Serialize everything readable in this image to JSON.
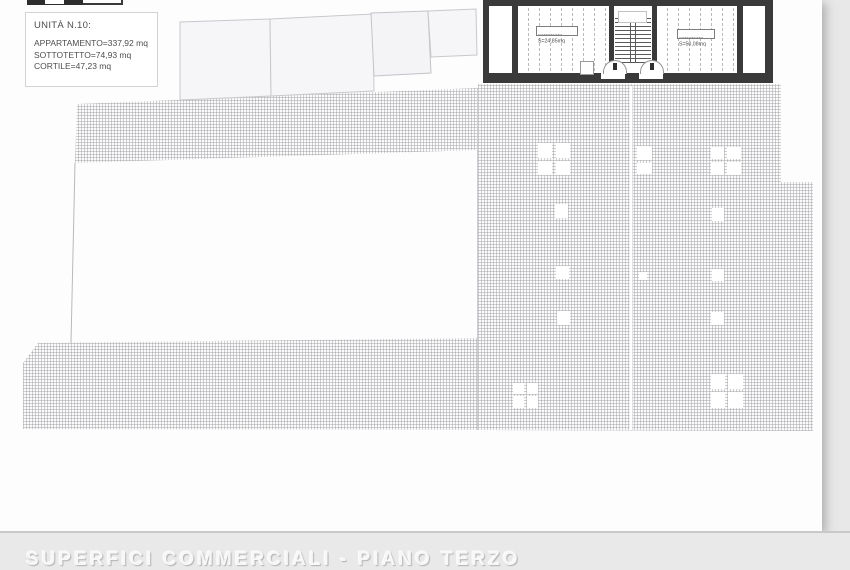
{
  "page": {
    "unit_info": {
      "title": "UNITÀ N.10:",
      "line_appartamento": "APPARTAMENTO=337,92 mq",
      "line_sottotetto": "SOTTOTETTO=74,93 mq",
      "line_cortile": "CORTILE=47,23 mq"
    },
    "attic_plan": {
      "left_room_tag": "SOTTOTETTO",
      "left_room_area": "S=24,85mq",
      "right_room_tag": "SOTTOTETTO",
      "right_room_area": "S=50,08mq"
    },
    "footer_caption": "SUPERFICI COMMERCIALI - PIANO TERZO",
    "icons": {
      "scale_bar": "scale-bar-icon"
    },
    "colors": {
      "wall": "#3a3a3a",
      "hatch_line": "#c9c9cd",
      "paper": "#fdfdfd",
      "backdrop": "#e8e8e8",
      "footer_text": "#f7f7f7"
    }
  }
}
